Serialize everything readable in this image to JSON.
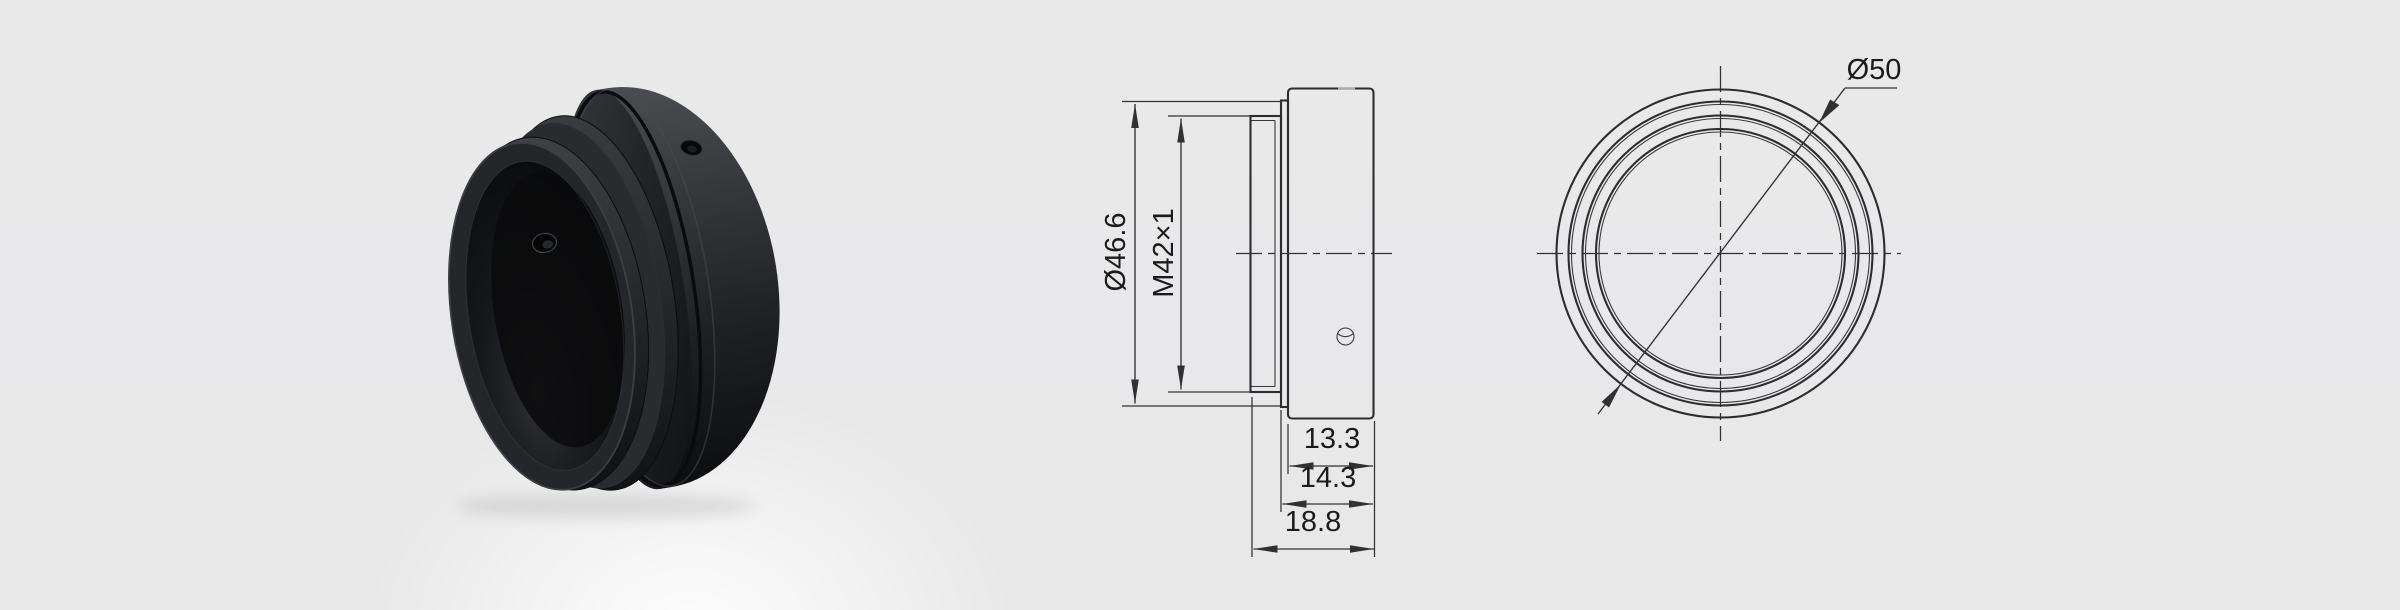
{
  "theme": {
    "background": "#e9e9ea",
    "drawing_line_color": "#2b2d2f",
    "dimension_text_color": "#1b1b1b",
    "product_color": "#1b1c1e"
  },
  "side_view": {
    "dims": [
      {
        "name": "step-outer-diameter",
        "label": "Ø46.6"
      },
      {
        "name": "thread-spec",
        "label": "M42×1"
      },
      {
        "name": "flange-depth",
        "label": "13.3"
      },
      {
        "name": "step-depth",
        "label": "14.3"
      },
      {
        "name": "overall-depth",
        "label": "18.8"
      }
    ]
  },
  "front_view": {
    "dims": [
      {
        "name": "outer-diameter",
        "label": "Ø50"
      }
    ]
  }
}
